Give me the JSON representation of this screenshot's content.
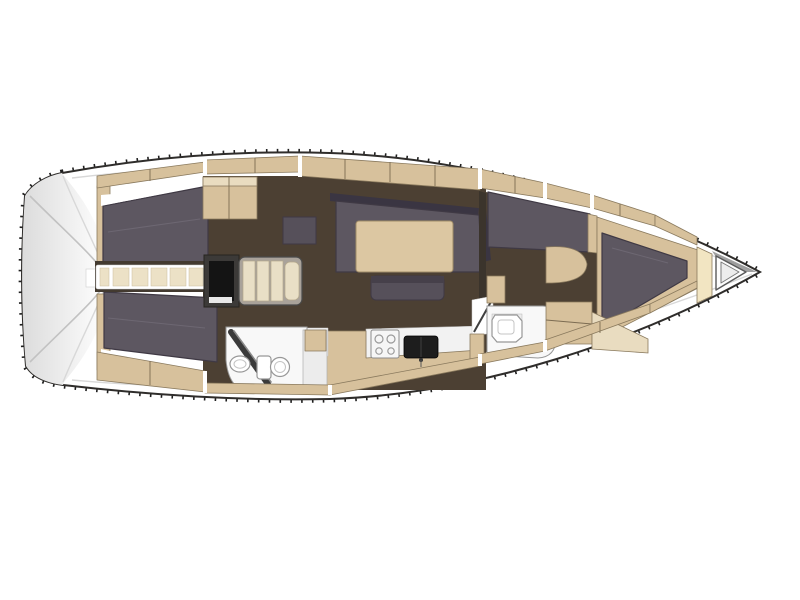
{
  "figure": {
    "type": "yacht-interior-floor-plan",
    "orientation": "bow-right",
    "regions": [
      "transom-swim-platform",
      "aft-cabin-port",
      "aft-cabin-starboard",
      "companionway-steps",
      "saloon-sofa-and-table",
      "galley",
      "aft-head",
      "forward-head",
      "forward-cabin-v-berth",
      "bow-anchor-locker"
    ]
  },
  "colors": {
    "outline": "#2f2d2b",
    "hull-fill": "#ffffff",
    "deck-shade": "#d8d8d8",
    "trim": "#d7c19c",
    "trim-light": "#e9dcc0",
    "trim-dark": "#8a7a5e",
    "floor": "#4c4033",
    "floor-dark": "#433a30",
    "berth": "#5d5761",
    "berth-edge": "#3f3944",
    "berth-seam": "#6d6772",
    "sofa-frame": "#3a3542",
    "table": "#dcc7a2",
    "bench": "#56505a",
    "head-white": "#f8f8f8",
    "fixture-stroke": "#979797",
    "sink": "#1d1d1d",
    "cream": "#f2e5c2",
    "plank": "#ece1c6",
    "step-tread": "#e9dfc6",
    "step-frame": "#3c3a38"
  }
}
